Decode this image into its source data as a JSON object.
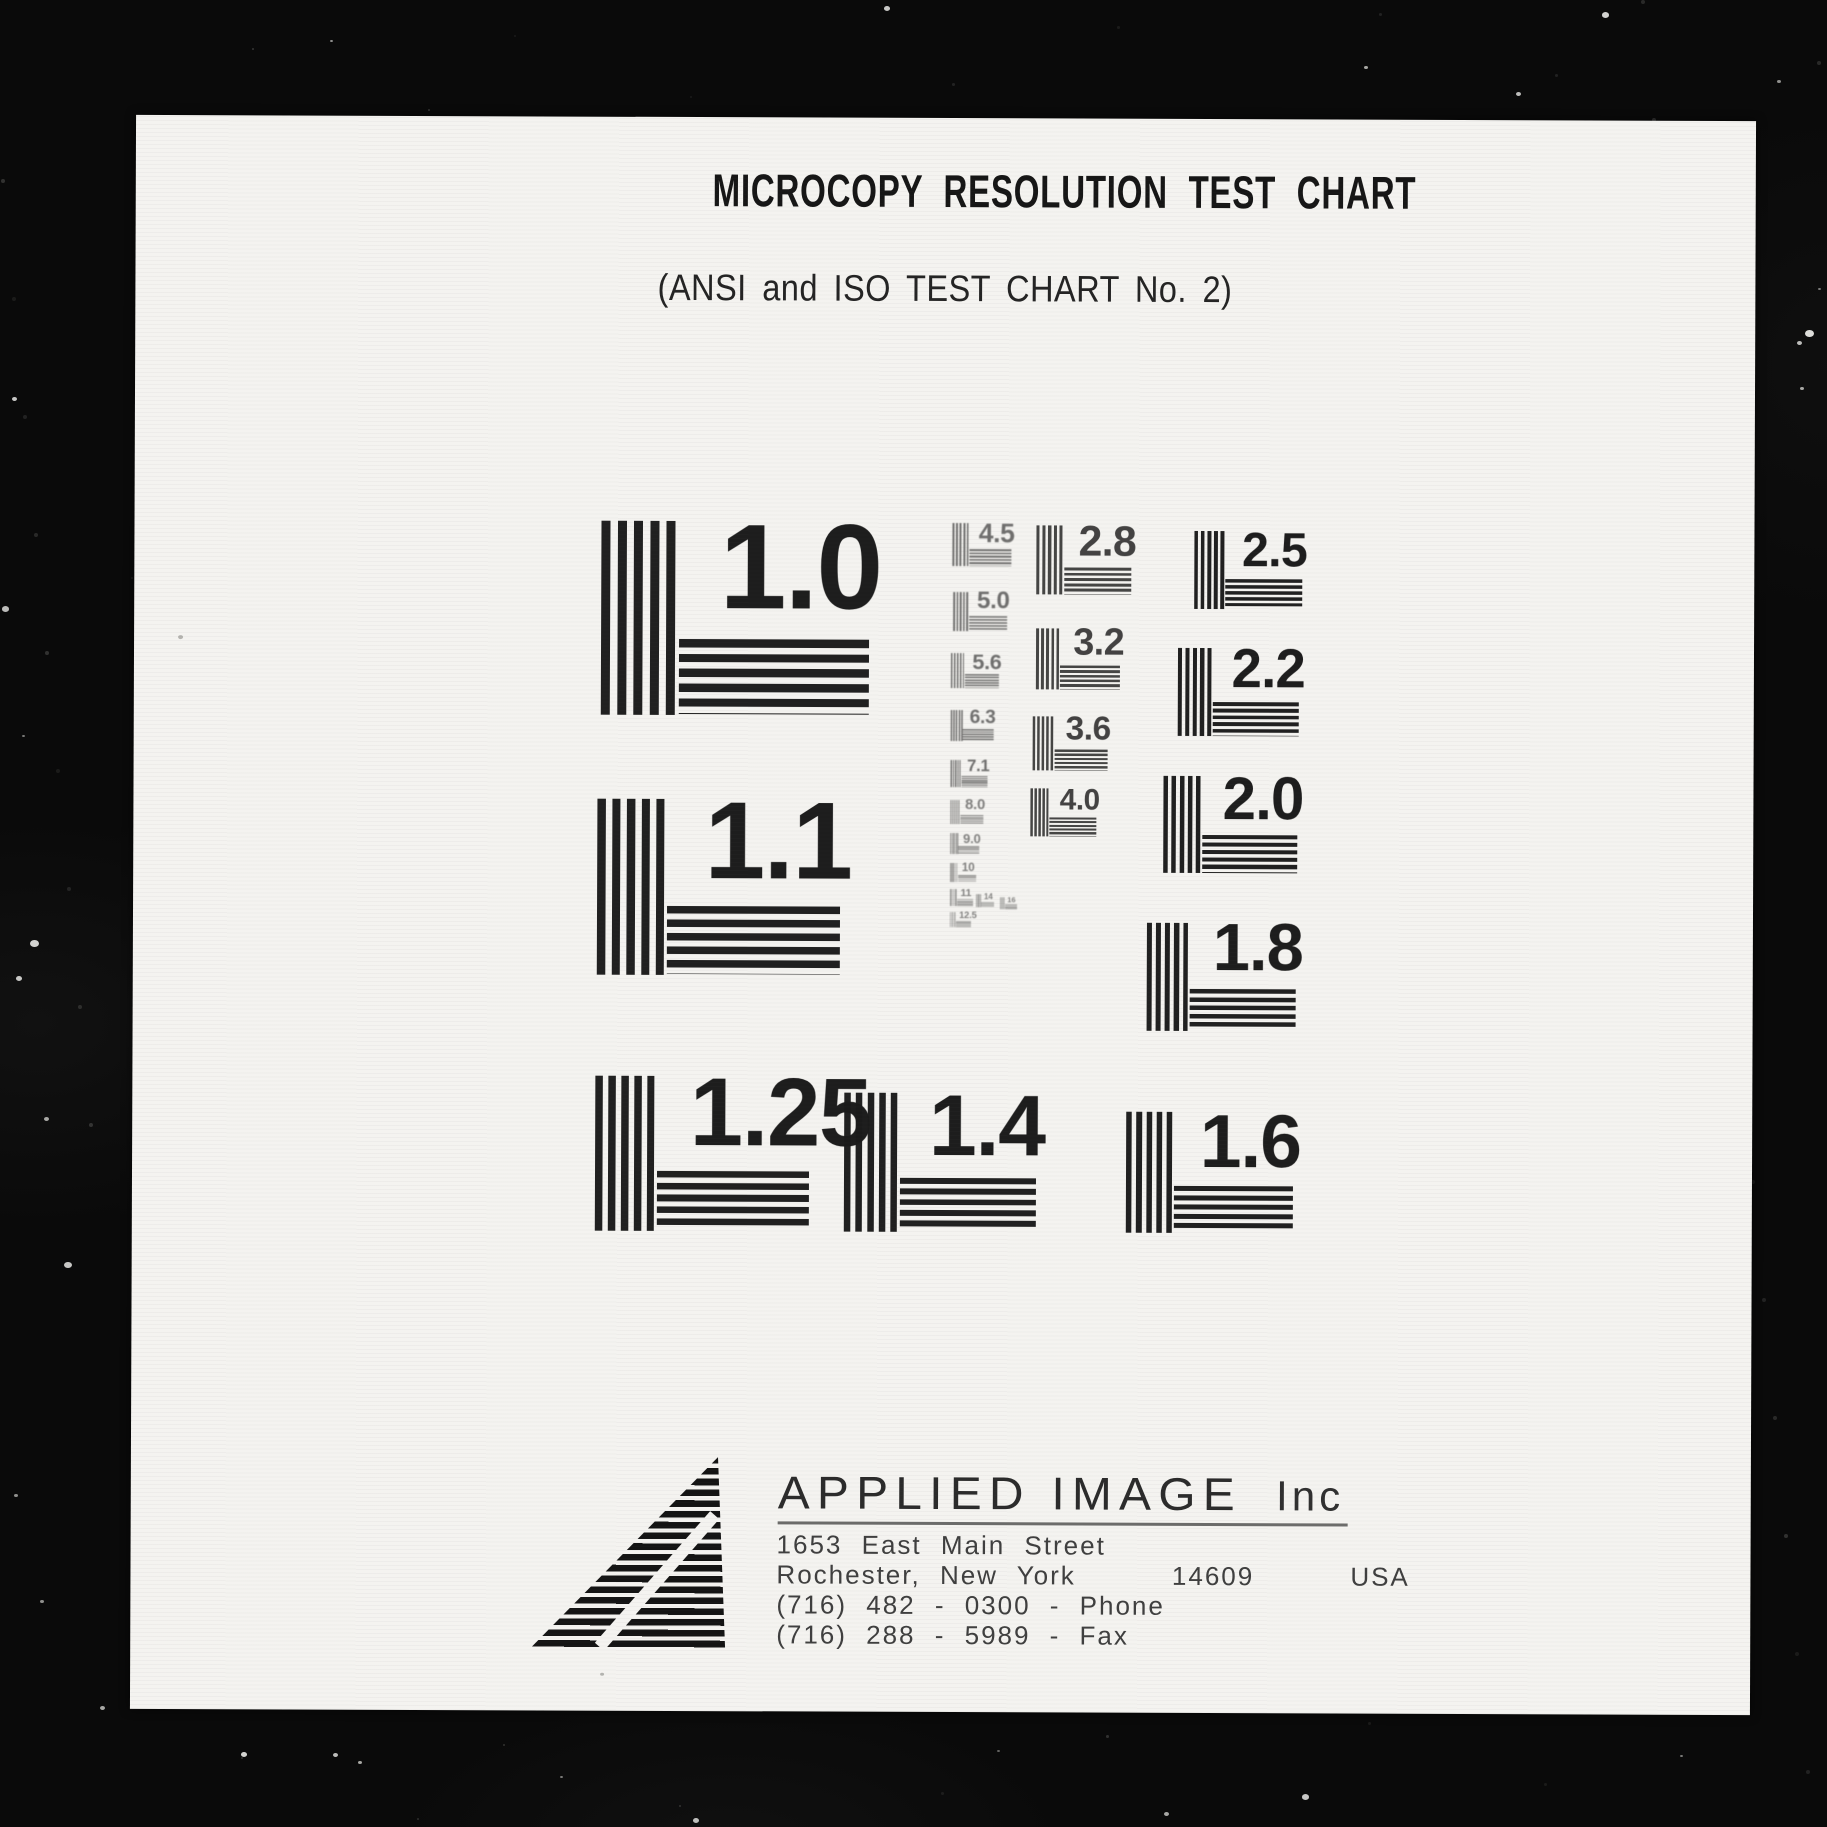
{
  "header": {
    "title": "MICROCOPY RESOLUTION TEST CHART",
    "subtitle": "(ANSI and ISO TEST CHART No. 2)"
  },
  "test_patterns": [
    {
      "label": "1.0",
      "x": 467,
      "y": 404,
      "size": 194
    },
    {
      "label": "1.1",
      "x": 464,
      "y": 682,
      "size": 176
    },
    {
      "label": "1.25",
      "x": 463,
      "y": 959,
      "size": 155
    },
    {
      "label": "1.4",
      "x": 712,
      "y": 975,
      "size": 139
    },
    {
      "label": "1.6",
      "x": 994,
      "y": 993,
      "size": 121
    },
    {
      "label": "1.8",
      "x": 1014,
      "y": 804,
      "size": 108
    },
    {
      "label": "2.0",
      "x": 1030,
      "y": 657,
      "size": 97
    },
    {
      "label": "2.2",
      "x": 1044,
      "y": 529,
      "size": 88
    },
    {
      "label": "2.5",
      "x": 1060,
      "y": 412,
      "size": 78
    },
    {
      "label": "2.8",
      "x": 902,
      "y": 407,
      "size": 69
    },
    {
      "label": "3.2",
      "x": 902,
      "y": 510,
      "size": 61
    },
    {
      "label": "3.6",
      "x": 899,
      "y": 598,
      "size": 54
    },
    {
      "label": "4.0",
      "x": 897,
      "y": 670,
      "size": 48
    },
    {
      "label": "4.5",
      "x": 818,
      "y": 405,
      "size": 43
    },
    {
      "label": "5.0",
      "x": 819,
      "y": 474,
      "size": 39
    },
    {
      "label": "5.6",
      "x": 817,
      "y": 535,
      "size": 35
    },
    {
      "label": "6.3",
      "x": 817,
      "y": 592,
      "size": 31
    },
    {
      "label": "7.1",
      "x": 817,
      "y": 642,
      "size": 27
    },
    {
      "label": "8.0",
      "x": 817,
      "y": 682,
      "size": 24
    },
    {
      "label": "9.0",
      "x": 817,
      "y": 715,
      "size": 21
    },
    {
      "label": "10",
      "x": 817,
      "y": 745,
      "size": 19
    },
    {
      "label": "11",
      "x": 817,
      "y": 771,
      "size": 17
    },
    {
      "label": "12.5",
      "x": 817,
      "y": 794,
      "size": 15
    },
    {
      "label": "14",
      "x": 843,
      "y": 776,
      "size": 13
    },
    {
      "label": "16",
      "x": 867,
      "y": 779,
      "size": 12
    }
  ],
  "footer": {
    "company": "APPLIED IMAGE",
    "company_suffix": "Inc",
    "address_lines": [
      "1653 East Main Street",
      "Rochester, New York     14609     USA",
      "(716) 482 - 0300 - Phone",
      "(716) 288 - 5989 - Fax"
    ]
  },
  "colors": {
    "film_black": "#0a0a0a",
    "paper_white": "#f4f3f0",
    "ink_black": "#1a1a1a"
  }
}
